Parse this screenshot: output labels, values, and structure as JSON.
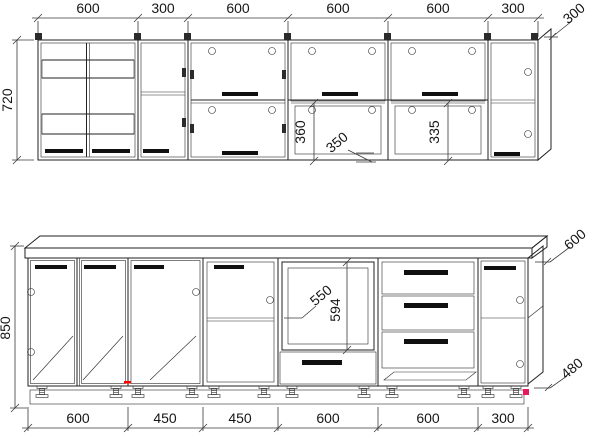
{
  "drawing_type": "kitchen-cabinet-dimension-drawing",
  "upper_row": {
    "widths": [
      "600",
      "300",
      "600",
      "600",
      "600",
      "300"
    ],
    "height": "720",
    "depth": "300",
    "open_niche_left_height": "360",
    "shelf_leader": "350",
    "open_niche_right_height": "335"
  },
  "lower_row": {
    "widths": [
      "600",
      "450",
      "450",
      "600",
      "600",
      "300"
    ],
    "height": "850",
    "countertop_depth": "600",
    "base_depth": "480",
    "appliance_niche_depth": "550",
    "appliance_niche_height": "594"
  },
  "colors": {
    "line": "#222222",
    "dim_text": "#161616",
    "handle": "#101010",
    "red_mark": "#ff0000",
    "magenta_mark": "#e8175f",
    "background": "#ffffff"
  }
}
